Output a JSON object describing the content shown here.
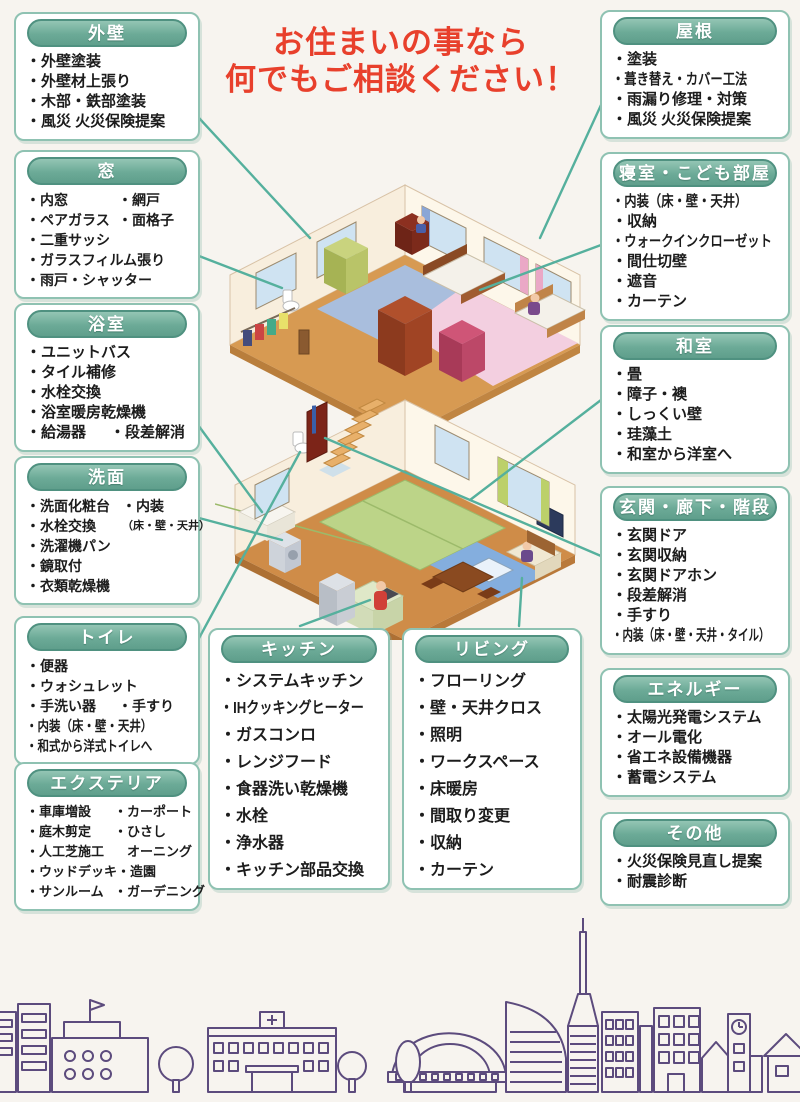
{
  "title": {
    "line1": "お住まいの事なら",
    "line2": "何でもご相談ください！"
  },
  "theme": {
    "headline_red": "#e8402c",
    "pill_green": "#6caa97",
    "box_border_green": "#8fc2b2",
    "connector_teal": "#55b09d",
    "skyline_purple": "#5c4b7d",
    "paper": "#f7f4ef"
  },
  "boxes": [
    {
      "id": "exterior-wall",
      "title": "外壁",
      "lines": [
        [
          "・外壁塗装"
        ],
        [
          "・外壁材上張り"
        ],
        [
          "・木部・鉄部塗装"
        ],
        [
          "・風災 火災保険提案"
        ]
      ]
    },
    {
      "id": "window",
      "title": "窓",
      "lines": [
        [
          "・内窓",
          "・網戸"
        ],
        [
          "・ペアガラス",
          "・面格子"
        ],
        [
          "・二重サッシ"
        ],
        [
          "・ガラスフィルム張り"
        ],
        [
          "・雨戸・シャッター"
        ]
      ]
    },
    {
      "id": "bathroom",
      "title": "浴室",
      "lines": [
        [
          "・ユニットバス"
        ],
        [
          "・タイル補修"
        ],
        [
          "・水栓交換"
        ],
        [
          "・浴室暖房乾燥機"
        ],
        [
          "・給湯器",
          "・段差解消"
        ]
      ]
    },
    {
      "id": "washroom",
      "title": "洗面",
      "lines": [
        [
          "・洗面化粧台",
          "・内装"
        ],
        [
          "・水栓交換",
          "（床・壁・天井）"
        ],
        [
          "・洗濯機パン"
        ],
        [
          "・鏡取付"
        ],
        [
          "・衣類乾燥機"
        ]
      ]
    },
    {
      "id": "toilet",
      "title": "トイレ",
      "lines": [
        [
          "・便器"
        ],
        [
          "・ウォシュレット"
        ],
        [
          "・手洗い器",
          "・手すり"
        ],
        [
          "・内装（床・壁・天井）"
        ],
        [
          "・和式から洋式トイレへ"
        ]
      ]
    },
    {
      "id": "exterior",
      "title": "エクステリア",
      "lines": [
        [
          "・車庫増設",
          "・カーポート"
        ],
        [
          "・庭木剪定",
          "・ひさし"
        ],
        [
          "・人工芝施工",
          "　オーニング"
        ],
        [
          "・ウッドデッキ",
          "・造園"
        ],
        [
          "・サンルーム",
          "・ガーデニング"
        ]
      ]
    },
    {
      "id": "kitchen",
      "title": "キッチン",
      "lines": [
        [
          "・システムキッチン"
        ],
        [
          "・IHクッキングヒーター"
        ],
        [
          "・ガスコンロ"
        ],
        [
          "・レンジフード"
        ],
        [
          "・食器洗い乾燥機"
        ],
        [
          "・水栓"
        ],
        [
          "・浄水器"
        ],
        [
          "・キッチン部品交換"
        ]
      ]
    },
    {
      "id": "living",
      "title": "リビング",
      "lines": [
        [
          "・フローリング"
        ],
        [
          "・壁・天井クロス"
        ],
        [
          "・照明"
        ],
        [
          "・ワークスペース"
        ],
        [
          "・床暖房"
        ],
        [
          "・間取り変更"
        ],
        [
          "・収納"
        ],
        [
          "・カーテン"
        ]
      ]
    },
    {
      "id": "roof",
      "title": "屋根",
      "lines": [
        [
          "・塗装"
        ],
        [
          "・葺き替え・カバー工法"
        ],
        [
          "・雨漏り修理・対策"
        ],
        [
          "・風災 火災保険提案"
        ]
      ]
    },
    {
      "id": "bedroom",
      "title": "寝室・こども部屋",
      "lines": [
        [
          "・内装（床・壁・天井）"
        ],
        [
          "・収納"
        ],
        [
          "・ウォークインクローゼット"
        ],
        [
          "・間仕切壁"
        ],
        [
          "・遮音"
        ],
        [
          "・カーテン"
        ]
      ]
    },
    {
      "id": "japanese-room",
      "title": "和室",
      "lines": [
        [
          "・畳"
        ],
        [
          "・障子・襖"
        ],
        [
          "・しっくい壁"
        ],
        [
          "・珪藻土"
        ],
        [
          "・和室から洋室へ"
        ]
      ]
    },
    {
      "id": "entrance",
      "title": "玄関・廊下・階段",
      "lines": [
        [
          "・玄関ドア"
        ],
        [
          "・玄関収納"
        ],
        [
          "・玄関ドアホン"
        ],
        [
          "・段差解消"
        ],
        [
          "・手すり"
        ],
        [
          "・内装（床・壁・天井・タイル）"
        ]
      ]
    },
    {
      "id": "energy",
      "title": "エネルギー",
      "lines": [
        [
          "・太陽光発電システム"
        ],
        [
          "・オール電化"
        ],
        [
          "・省エネ設備機器"
        ],
        [
          "・蓄電システム"
        ]
      ]
    },
    {
      "id": "other",
      "title": "その他",
      "lines": [
        [
          "・火災保険見直し提案"
        ],
        [
          "・耐震診断"
        ]
      ]
    }
  ]
}
